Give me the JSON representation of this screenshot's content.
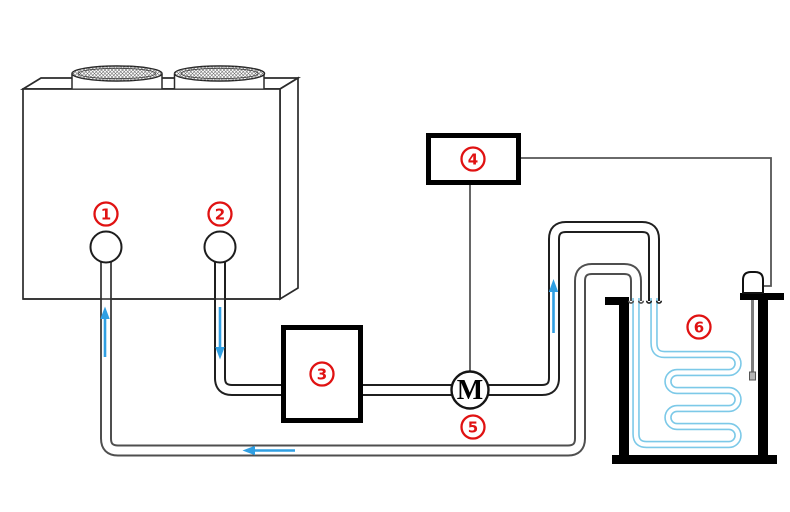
{
  "diagram": {
    "type": "refrigeration-system-schematic",
    "labels": {
      "m1": "1",
      "m2": "2",
      "m3": "3",
      "m4": "4",
      "m5": "5",
      "m6": "6",
      "motor": "M"
    },
    "colors": {
      "red": "#e01212",
      "arrow-blue": "#2f9fe3",
      "coil-blue": "#7cc9e8",
      "pipe-dark": "#1f1f1f",
      "pipe-gray": "#4f4f4f",
      "wire-gray": "#555555",
      "black": "#000000",
      "probe-gray": "#7d7d7d"
    }
  }
}
